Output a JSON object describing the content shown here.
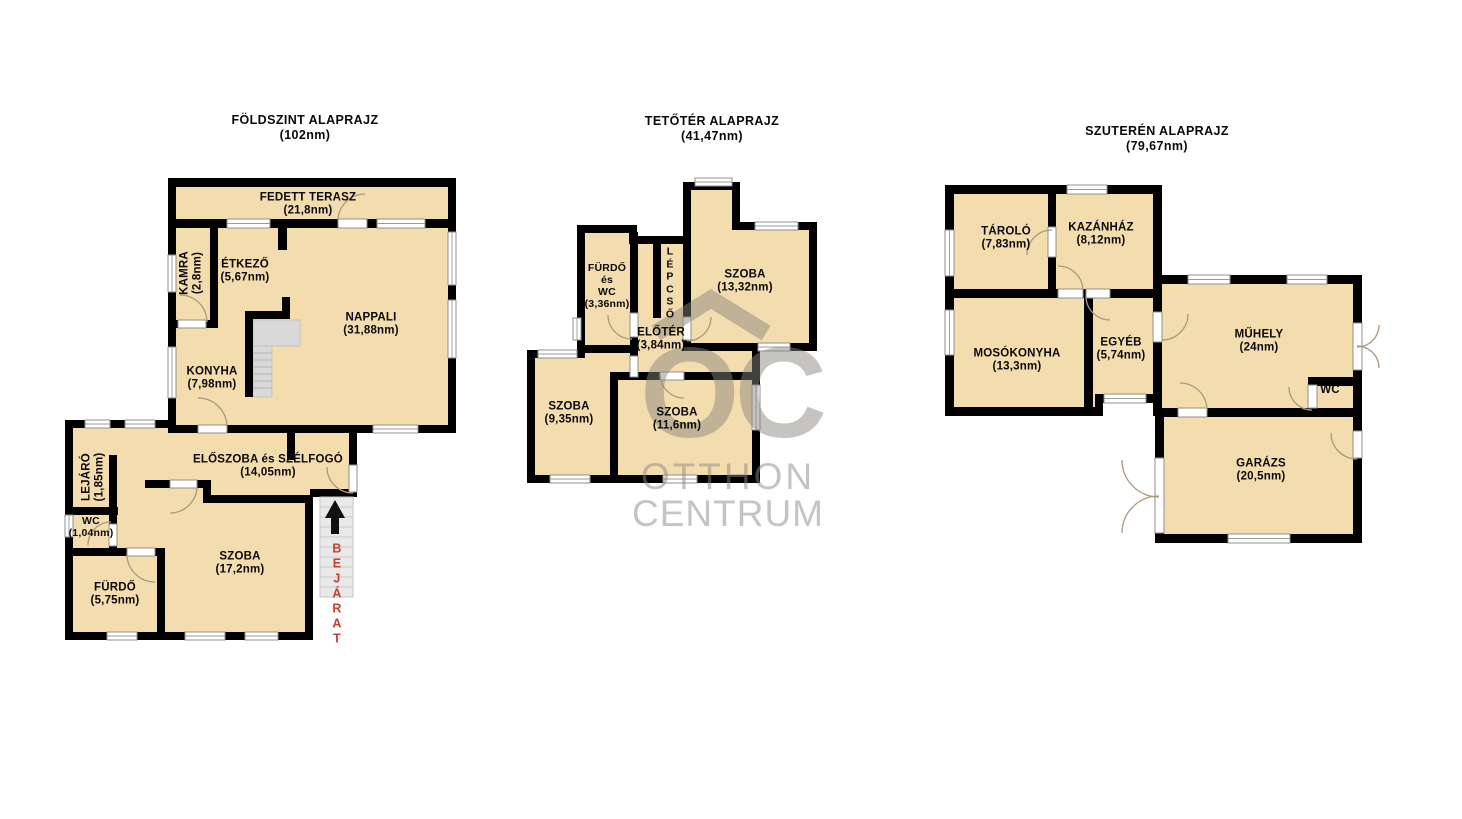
{
  "plans": {
    "ground": {
      "title": "FÖLDSZINT ALAPRAJZ",
      "area": "(102nm)",
      "rooms": {
        "terasz": {
          "name": "FEDETT TERASZ",
          "area": "(21,8nm)"
        },
        "kamra": {
          "name": "KAMRA",
          "area": "(2,8nm)"
        },
        "etkezo": {
          "name": "ÉTKEZŐ",
          "area": "(5,67nm)"
        },
        "nappali": {
          "name": "NAPPALI",
          "area": "(31,88nm)"
        },
        "konyha": {
          "name": "KONYHA",
          "area": "(7,98nm)"
        },
        "eloszoba": {
          "name": "ELŐSZOBA és SZÉLFOGÓ",
          "area": "(14,05nm)"
        },
        "lejaro": {
          "name": "LEJÁRÓ",
          "area": "(1,85nm)"
        },
        "wc": {
          "name": "WC",
          "area": "(1,04nm)"
        },
        "furdo": {
          "name": "FÜRDŐ",
          "area": "(5,75nm)"
        },
        "szoba": {
          "name": "SZOBA",
          "area": "(17,2nm)"
        }
      },
      "entrance_letters": [
        "B",
        "E",
        "J",
        "Á",
        "R",
        "A",
        "T"
      ]
    },
    "attic": {
      "title": "TETŐTÉR ALAPRAJZ",
      "area": "(41,47nm)",
      "rooms": {
        "furdo_wc": {
          "line1": "FÜRDŐ",
          "line2": "és",
          "line3": "WC",
          "area": "(3,36nm)"
        },
        "lepcso_letters": [
          "L",
          "É",
          "P",
          "C",
          "S",
          "Ő"
        ],
        "szoba1": {
          "name": "SZOBA",
          "area": "(13,32nm)"
        },
        "eloter": {
          "name": "ELŐTÉR",
          "area": "(3,84nm)"
        },
        "szoba2": {
          "name": "SZOBA",
          "area": "(9,35nm)"
        },
        "szoba3": {
          "name": "SZOBA",
          "area": "(11,6nm)"
        }
      }
    },
    "basement": {
      "title": "SZUTERÉN ALAPRAJZ",
      "area": "(79,67nm)",
      "rooms": {
        "tarolo": {
          "name": "TÁROLÓ",
          "area": "(7,83nm)"
        },
        "kazanhaz": {
          "name": "KAZÁNHÁZ",
          "area": "(8,12nm)"
        },
        "mosokonyha": {
          "name": "MOSÓKONYHA",
          "area": "(13,3nm)"
        },
        "egyeb": {
          "name": "EGYÉB",
          "area": "(5,74nm)"
        },
        "muhely": {
          "name": "MŰHELY",
          "area": "(24nm)"
        },
        "wc": {
          "name": "WC"
        },
        "garazs": {
          "name": "GARÁZS",
          "area": "(20,5nm)"
        }
      }
    }
  },
  "watermark": {
    "logo": "OC",
    "line1": "OTTHON",
    "line2": "CENTRUM"
  },
  "colors": {
    "room_fill": "#f3dcae",
    "wall": "#000000",
    "entrance_text": "#c5402e",
    "watermark": "#8a8680"
  }
}
